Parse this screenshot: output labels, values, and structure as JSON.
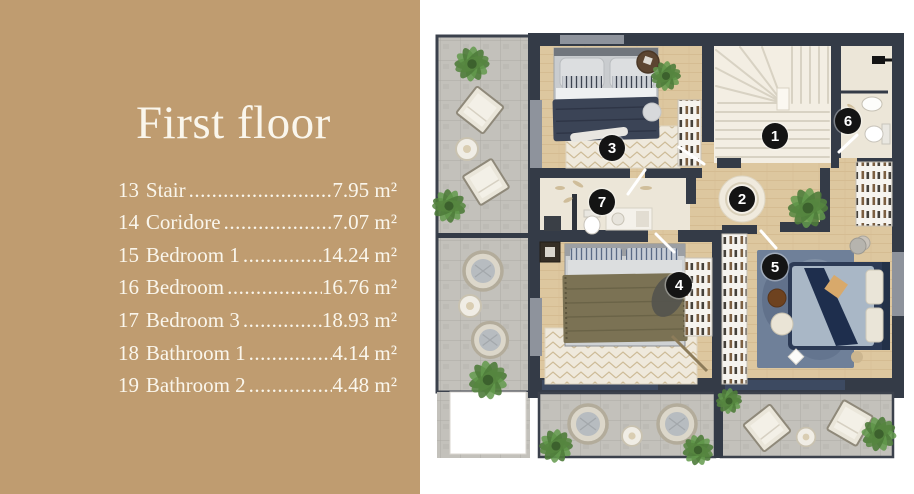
{
  "sidebar": {
    "title": "First floor",
    "items": [
      {
        "num": "13",
        "label": "Stair",
        "dots": "..........................................................",
        "area": "7.95 m²"
      },
      {
        "num": "14",
        "label": "Coridore",
        "dots": "..........................................................",
        "area": "7.07 m²"
      },
      {
        "num": "15",
        "label": "Bedroom 1",
        "dots": "..........................................................",
        "area": "14.24 m²"
      },
      {
        "num": "16",
        "label": "Bedroom",
        "dots": "..........................................................",
        "area": "16.76 m²"
      },
      {
        "num": "17",
        "label": "Bedroom 3",
        "dots": "..........................................................",
        "area": "18.93 m²"
      },
      {
        "num": "18",
        "label": "Bathroom 1",
        "dots": "..........................................................",
        "area": "4.14 m²"
      },
      {
        "num": "19",
        "label": "Bathroom 2",
        "dots": "..........................................................",
        "area": "4.48 m²"
      }
    ]
  },
  "plan": {
    "markers": [
      {
        "label": "1",
        "room": "stair",
        "x": 355,
        "y": 136
      },
      {
        "label": "2",
        "room": "coridore",
        "x": 322,
        "y": 199
      },
      {
        "label": "3",
        "room": "bedroom-1",
        "x": 192,
        "y": 148
      },
      {
        "label": "4",
        "room": "bedroom",
        "x": 259,
        "y": 285
      },
      {
        "label": "5",
        "room": "bedroom-3",
        "x": 355,
        "y": 267
      },
      {
        "label": "6",
        "room": "bathroom-1",
        "x": 428,
        "y": 121
      },
      {
        "label": "7",
        "room": "bathroom-2",
        "x": 182,
        "y": 202
      }
    ],
    "colors": {
      "sidebar_bg": "#bf9c70",
      "sidebar_text": "#faf6ec",
      "wall": "#343b47",
      "wood": "#ddc79f",
      "stair_floor": "#f3eee3",
      "bath_floor": "#ece6d8",
      "terrace_tile": "#c3c1bb",
      "rug_white": "#efe9dc",
      "rug_blue": "#6f8099",
      "bed_navy": "#2c3a55",
      "bed_olive": "#7b7254",
      "duvet_navy": "#3b4456",
      "plant": "#4f7c3b",
      "lintel": "#3d4a61",
      "marker_bg": "#141414",
      "marker_text": "#ffffff"
    }
  }
}
